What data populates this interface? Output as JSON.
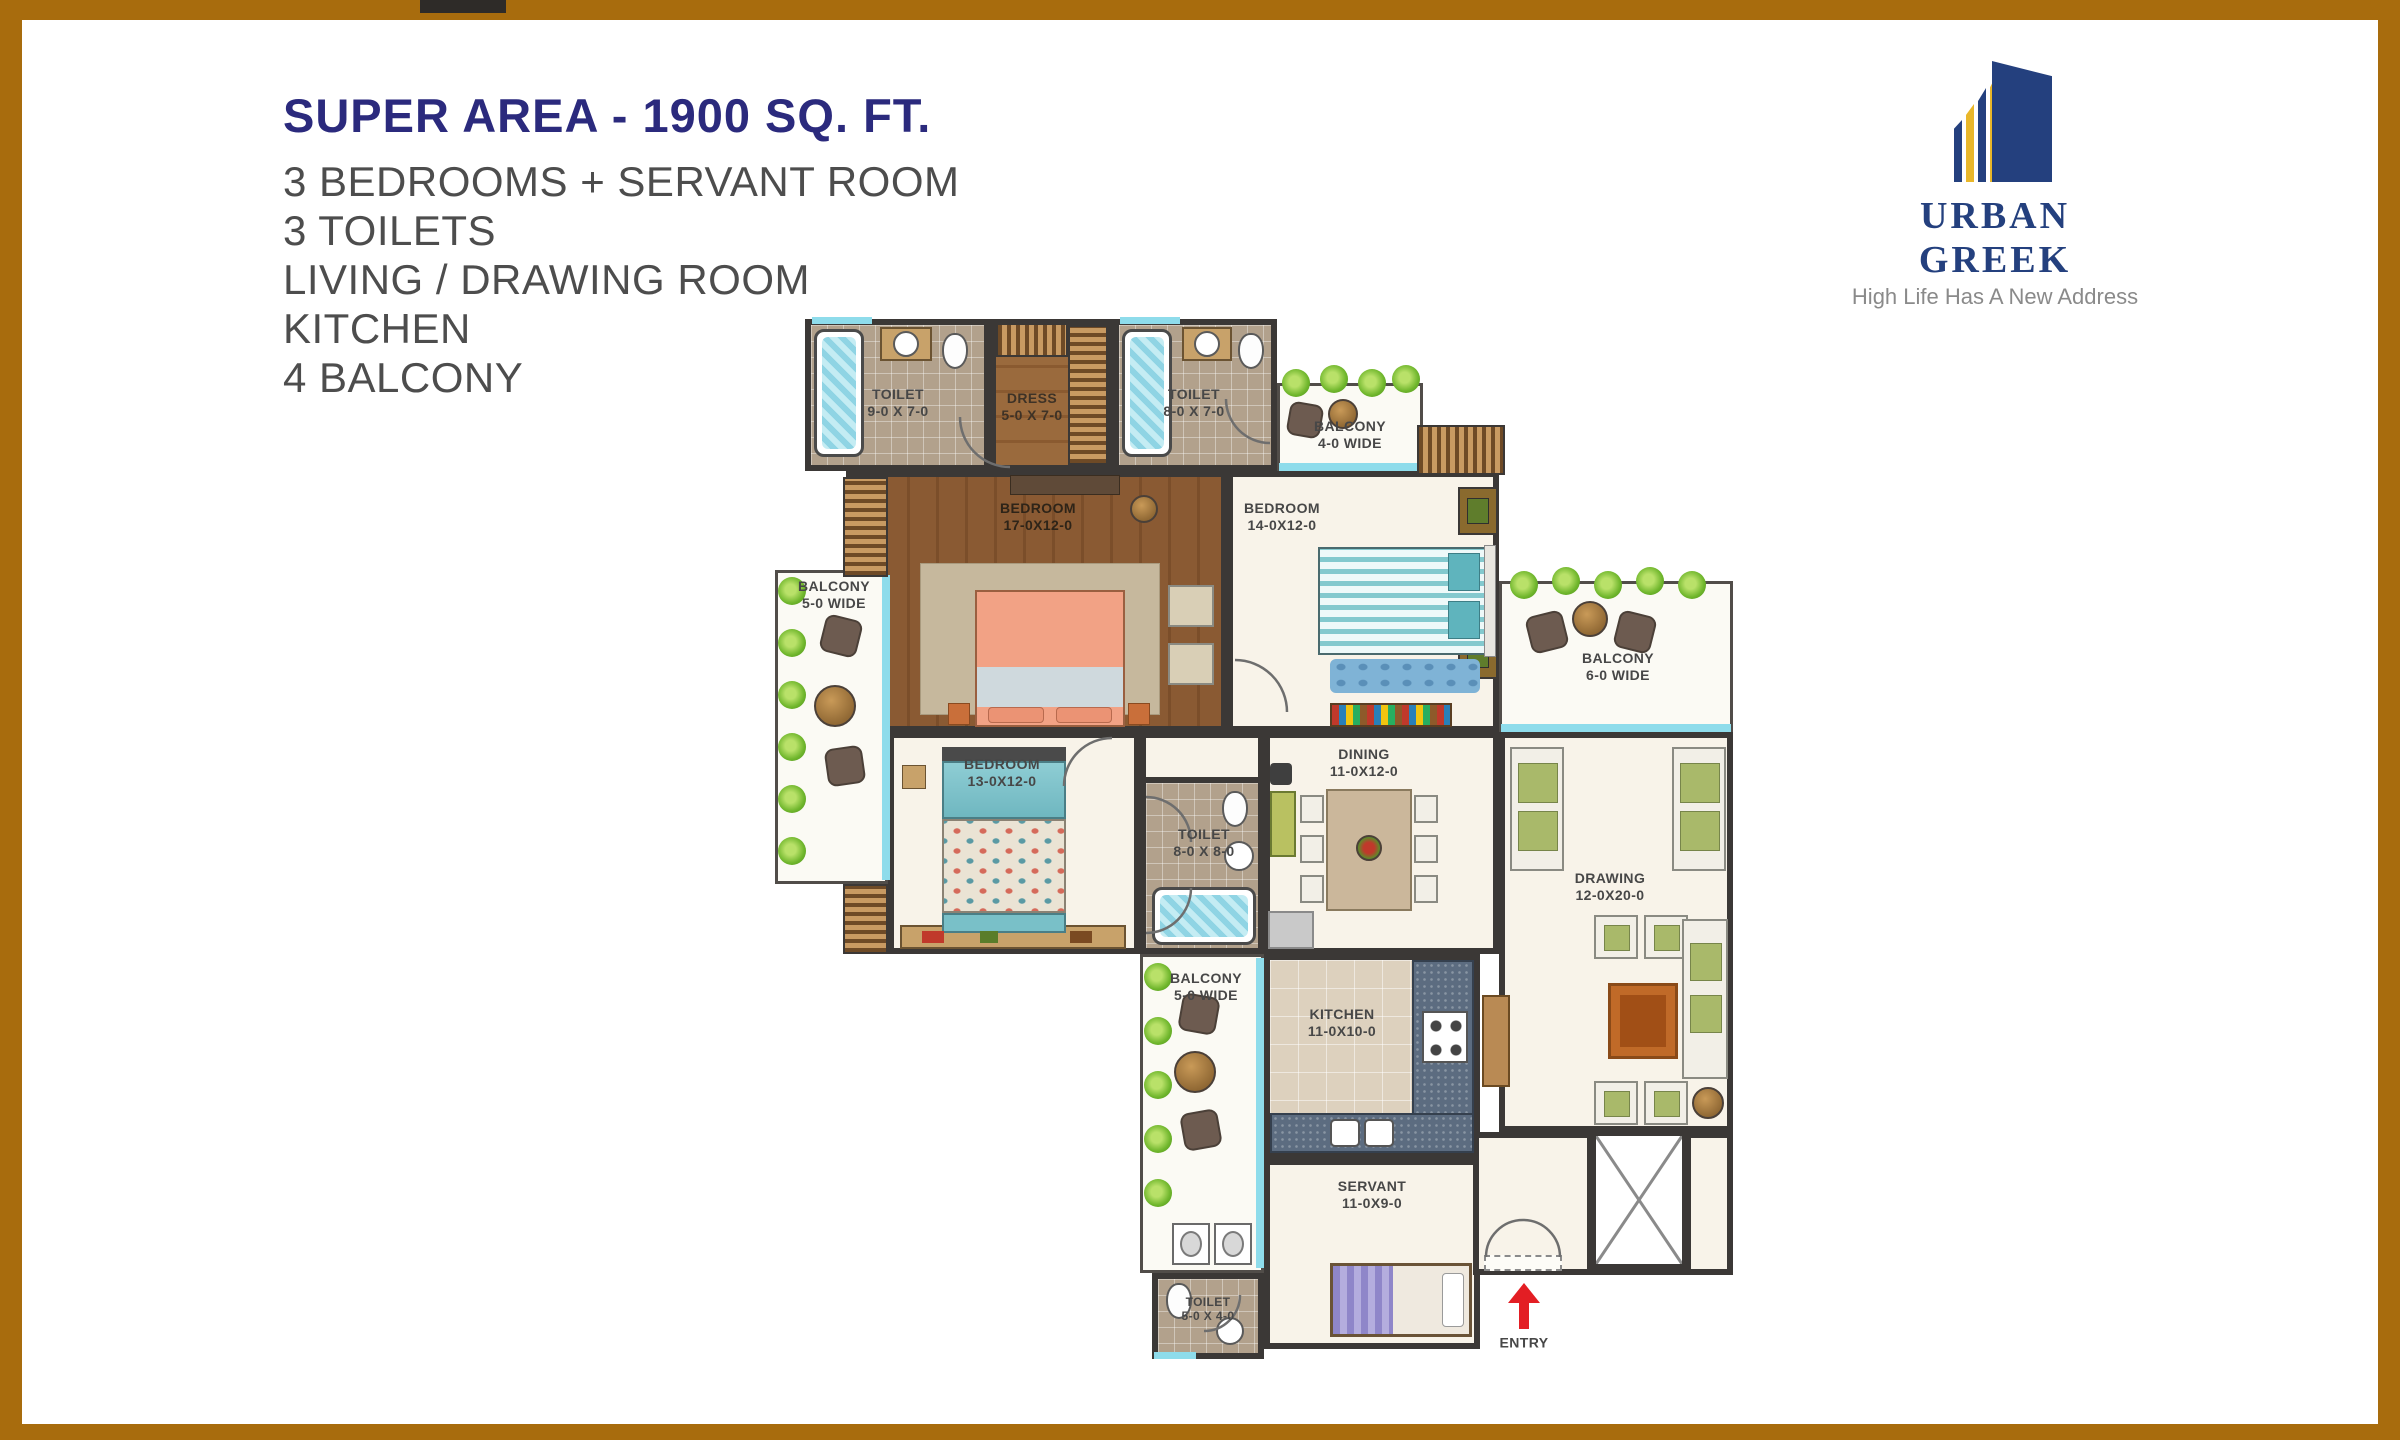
{
  "header": {
    "title": "SUPER AREA - 1900 SQ. FT.",
    "features": [
      "3 BEDROOMS + SERVANT ROOM",
      "3 TOILETS",
      "LIVING / DRAWING ROOM",
      "KITCHEN",
      "4 BALCONY"
    ]
  },
  "logo": {
    "brand": "URBAN GREEK",
    "tagline": "High Life Has A New Address"
  },
  "plan": {
    "rooms": [
      {
        "label": "TOILET",
        "dims": "9-0 X 7-0"
      },
      {
        "label": "DRESS",
        "dims": "5-0 X 7-0"
      },
      {
        "label": "TOILET",
        "dims": "8-0 X 7-0"
      },
      {
        "label": "BALCONY",
        "dims": "4-0 WIDE"
      },
      {
        "label": "BEDROOM",
        "dims": "17-0X12-0"
      },
      {
        "label": "BEDROOM",
        "dims": "14-0X12-0"
      },
      {
        "label": "BALCONY",
        "dims": "5-0 WIDE"
      },
      {
        "label": "BALCONY",
        "dims": "6-0 WIDE"
      },
      {
        "label": "BEDROOM",
        "dims": "13-0X12-0"
      },
      {
        "label": "TOILET",
        "dims": "8-0 X 8-0"
      },
      {
        "label": "DINING",
        "dims": "11-0X12-0"
      },
      {
        "label": "DRAWING",
        "dims": "12-0X20-0"
      },
      {
        "label": "BALCONY",
        "dims": "5-0 WIDE"
      },
      {
        "label": "KITCHEN",
        "dims": "11-0X10-0"
      },
      {
        "label": "SERVANT",
        "dims": "11-0X9-0"
      },
      {
        "label": "TOILET",
        "dims": "5-0 X 4-0"
      }
    ],
    "entry_label": "ENTRY"
  },
  "colors": {
    "border_brown": "#a86c0d",
    "title_navy": "#2b2a7d",
    "feature_gray": "#4d4d4d",
    "logo_navy": "#24407e",
    "logo_gold": "#e9b72a",
    "wall": "#3b3836",
    "glass_cyan": "#8edceb",
    "wood_floor": "#8a5a33",
    "master_bed_salmon": "#f2a285",
    "guest_bed_teal": "#7fc7cd",
    "plant_green": "#6fb62c",
    "granite_blue": "#5c6c80",
    "entry_arrow_red": "#e31e24"
  }
}
